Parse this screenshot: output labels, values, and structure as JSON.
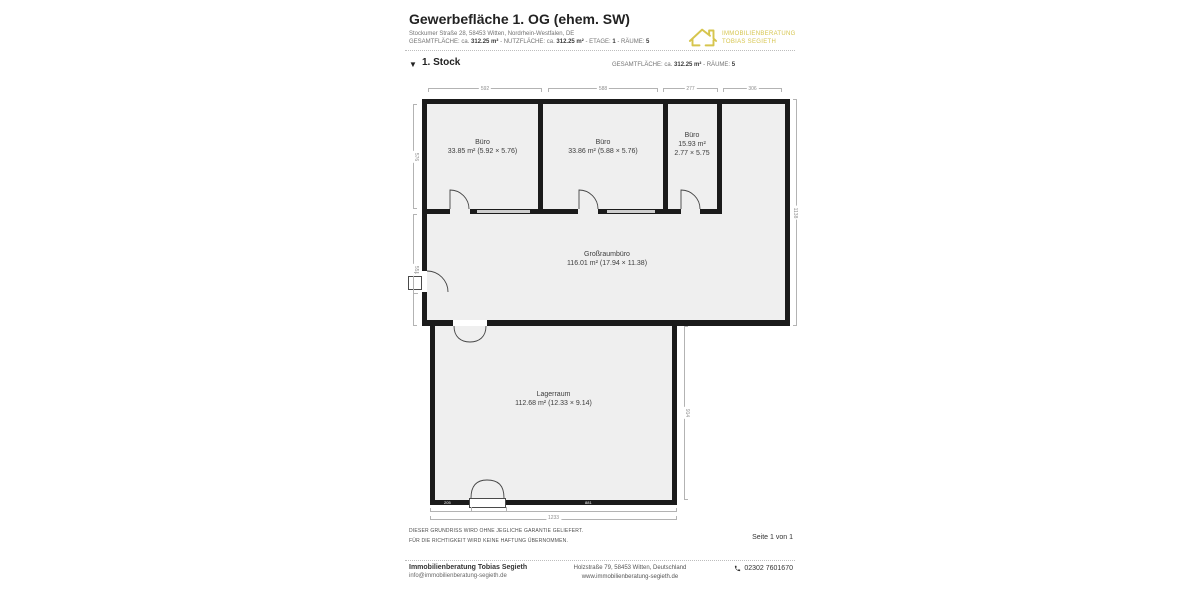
{
  "header": {
    "title": "Gewerbefläche 1. OG (ehem. SW)",
    "address": "Stockumer Straße 28, 58453 Witten, Nordrhein-Westfalen, DE",
    "meta_parts": [
      "GESAMTFLÄCHE: ca.",
      "312.25 m²",
      "- NUTZFLÄCHE: ca.",
      "312.25 m²",
      "- ETAGE:",
      "1",
      "- RÄUME:",
      "5"
    ],
    "logo": {
      "line1": "IMMOBILIENBERATUNG",
      "line2": "TOBIAS SEGIETH"
    }
  },
  "section": {
    "expander_icon": "▼",
    "floor_label": "1. Stock",
    "meta_parts": [
      "GESAMTFLÄCHE: ca.",
      "312.25 m²",
      "- RÄUME:",
      "5"
    ]
  },
  "plan": {
    "rooms": [
      {
        "lines": [
          "Büro",
          "33.85 m² (5.92 × 5.76)"
        ]
      },
      {
        "lines": [
          "Büro",
          "33.86 m² (5.88 × 5.76)"
        ]
      },
      {
        "lines": [
          "Büro",
          "15.93 m²",
          "2.77 × 5.75"
        ]
      },
      {
        "lines": [
          "Großraumbüro",
          "116.01 m² (17.94 × 11.38)"
        ]
      },
      {
        "lines": [
          "Lagerraum",
          "112.68 m² (12.33 × 9.14)"
        ]
      }
    ],
    "dims": {
      "top": [
        "592",
        "588",
        "277",
        "306"
      ],
      "left_upper": "576",
      "left_lower": "551",
      "right": "1138",
      "lager_right": "914",
      "bottom": "1233",
      "wall_left": "205",
      "wall_right": "881"
    }
  },
  "disclaimer": {
    "line1": "DIESER GRUNDRISS WIRD OHNE JEGLICHE GARANTIE GELIEFERT.",
    "line2": "FÜR DIE RICHTIGKEIT WIRD KEINE HAFTUNG ÜBERNOMMEN.",
    "page_label": "Seite 1 von 1"
  },
  "footer": {
    "company": "Immobilienberatung Tobias Segieth",
    "email": "info@immobilienberatung-segieth.de",
    "address": "Holzstraße 79, 58453 Witten, Deutschland",
    "website": "www.immobilienberatung-segieth.de",
    "phone": "02302 7601670"
  },
  "colors": {
    "wall": "#1b1b1b",
    "room_fill": "#efefef",
    "logo_yellow": "#d6c54e",
    "dim_gray": "#8f8f8f"
  }
}
